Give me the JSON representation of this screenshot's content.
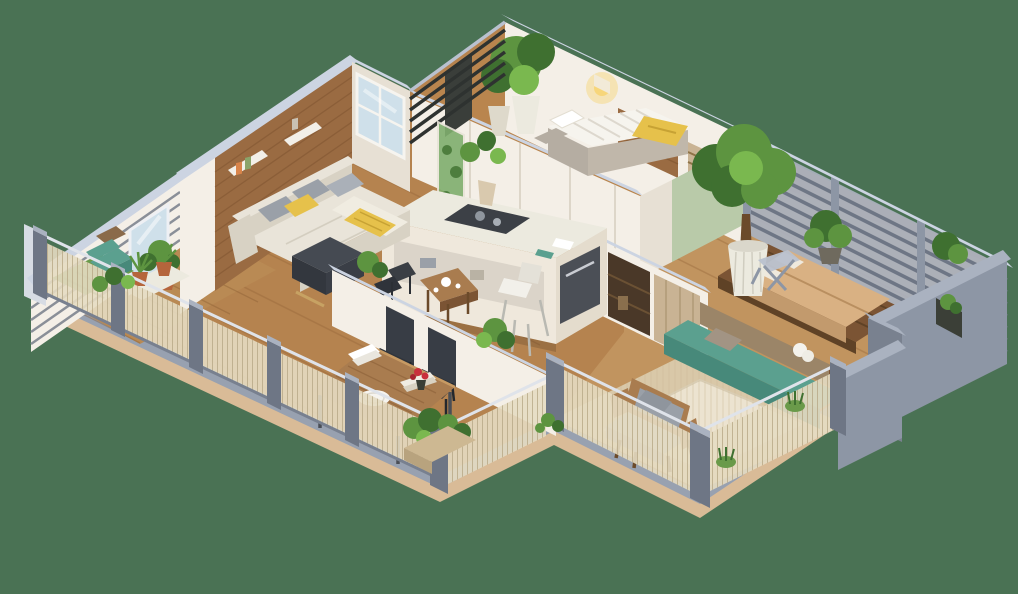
{
  "scene": {
    "type": "isometric-3d-floor-plan",
    "description": "Photorealistic 3D isometric cutaway floor plan of a modern apartment with wrap-around wooden terraces, metal mesh railings, louvered privacy walls and many plants",
    "rooms": [
      {
        "name": "living-room",
        "items": [
          "corner-sofa",
          "gray-pillows",
          "yellow-pillow",
          "yellow-throw",
          "dark-ottoman",
          "wood-accent-wall",
          "wall-shelves",
          "window",
          "floor-plant"
        ]
      },
      {
        "name": "left-balcony",
        "items": [
          "teal-cushion-chair",
          "grass-mat",
          "white-plant-tray",
          "terracotta-potted-plants",
          "mesh-railing",
          "glass-door"
        ]
      },
      {
        "name": "kitchen",
        "items": [
          "island-counter",
          "cooktop",
          "white-bar-stool",
          "built-in-appliance",
          "glass-shelf",
          "tea-table",
          "tea-set",
          "frame-chairs",
          "green-glass-panel",
          "island-vase-plant"
        ]
      },
      {
        "name": "small-bedroom",
        "items": [
          "single-bed",
          "white-duvet",
          "yellow-blanket",
          "stone-bed-base",
          "wood-headboard-panel",
          "glowing-wall-sconce",
          "slat-fence",
          "balcony-potted-trees"
        ]
      },
      {
        "name": "hallway",
        "items": [
          "wardrobe",
          "sliding-wood-door",
          "dark-storage-niche",
          "sage-accent-wall"
        ]
      },
      {
        "name": "right-bedroom-terrace",
        "items": [
          "double-mattress-bed",
          "wood-platform",
          "large-potted-tree",
          "white-ribbed-pot",
          "shrub",
          "metal-lounger",
          "louver-wall",
          "gray-privacy-walls",
          "wall-niche-plant"
        ]
      },
      {
        "name": "lounge-terrace",
        "items": [
          "teal-bench",
          "taupe-pillow",
          "white-towel",
          "wood-stool",
          "wood-armchair",
          "gray-cushions",
          "striped-rug",
          "grass-tufts",
          "mesh-railing"
        ]
      },
      {
        "name": "dining-terrace",
        "items": [
          "wood-dining-table",
          "black-leather-chairs",
          "white-plate",
          "napkin-stack",
          "red-roses",
          "books",
          "planter-boxes",
          "mesh-railing",
          "half-wall"
        ]
      }
    ]
  },
  "colors": {
    "background": "#4a7254",
    "base_tan": "#d9bb97",
    "base_gray": "#98a1b0",
    "wood_floor": "#b5834f",
    "wood_line": "#8a5c33",
    "deck_right": "#c1945f",
    "deck_light": "#d9c8a8",
    "balcony_deck": "#b98a54",
    "rug": "#ece3d0",
    "wall_white": "#f4efe7",
    "wall_shade": "#e7e0d4",
    "wall_cap": "#ccd4e2",
    "accent_wood": "#9a6b42",
    "accent_line": "#7c522e",
    "sage": "#b9caa9",
    "metal": "#8d96a5",
    "metal_dark": "#6e7685",
    "metal_light": "#aab2c0",
    "mesh": "#e6dcc2",
    "mesh_line": "#b8a987",
    "sofa": "#e9e4d9",
    "sofa_shade": "#d8d2c4",
    "pillow_gray": "#9aa0a8",
    "yellow": "#e6c14b",
    "teal": "#5ba08f",
    "teal_dark": "#47897a",
    "bed_tan": "#d9b183",
    "bed_tan_shade": "#c29a6d",
    "furn_wood": "#a97c4f",
    "furn_wood_dark": "#7b5434",
    "wood_door": "#c9b394",
    "taupe": "#9b8568",
    "pillow_taupe": "#a29484",
    "leaf": "#5d9440",
    "leaf_dark": "#3f7030",
    "leaf_light": "#7ab84f",
    "grass": "#6a9a4a",
    "chair_black": "#383d45",
    "cushion_gray": "#c3c8cf",
    "stone": "#b5ada2",
    "red": "#c9303c",
    "glass": "#cfe0ea",
    "glass_green": "#7fae6e",
    "pot_white": "#eceadf",
    "stool_white": "#f2f0ea",
    "white_soft": "#f6f4ee",
    "terracotta": "#b5653c",
    "dark_niche": "#4a3828",
    "appliance": "#4b4f56",
    "glow": "#f7d473",
    "slat_dark": "#2e3230"
  }
}
